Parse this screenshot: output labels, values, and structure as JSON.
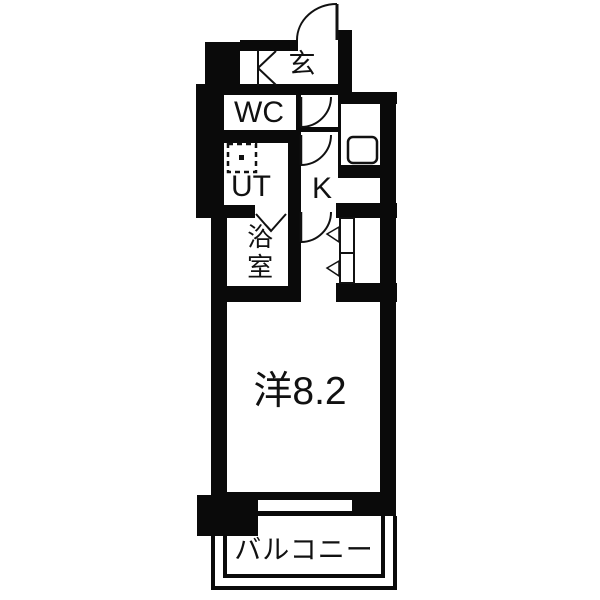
{
  "plan_type": "apartment-floor-plan",
  "rooms": {
    "entrance": "玄",
    "wc": "WC",
    "utility": "UT",
    "kitchen": "K",
    "bath": "浴室",
    "western_room": "洋8.2",
    "balcony": "バルコニー"
  },
  "colors": {
    "wall": "#0a0a0a",
    "floor": "#ffffff",
    "line": "#111111"
  },
  "symbols": [
    "entrance-door-swing-icon",
    "wc-door-swing-icon",
    "kitchen-door-swing-icon",
    "room-door-swing-icon",
    "bath-folding-door-icon",
    "closet-door-panels-icon",
    "closet-open-direction-icons",
    "shoe-cabinet-icon",
    "washing-machine-icon",
    "kitchen-sink-icon",
    "window-opening",
    "corner-pillar"
  ]
}
